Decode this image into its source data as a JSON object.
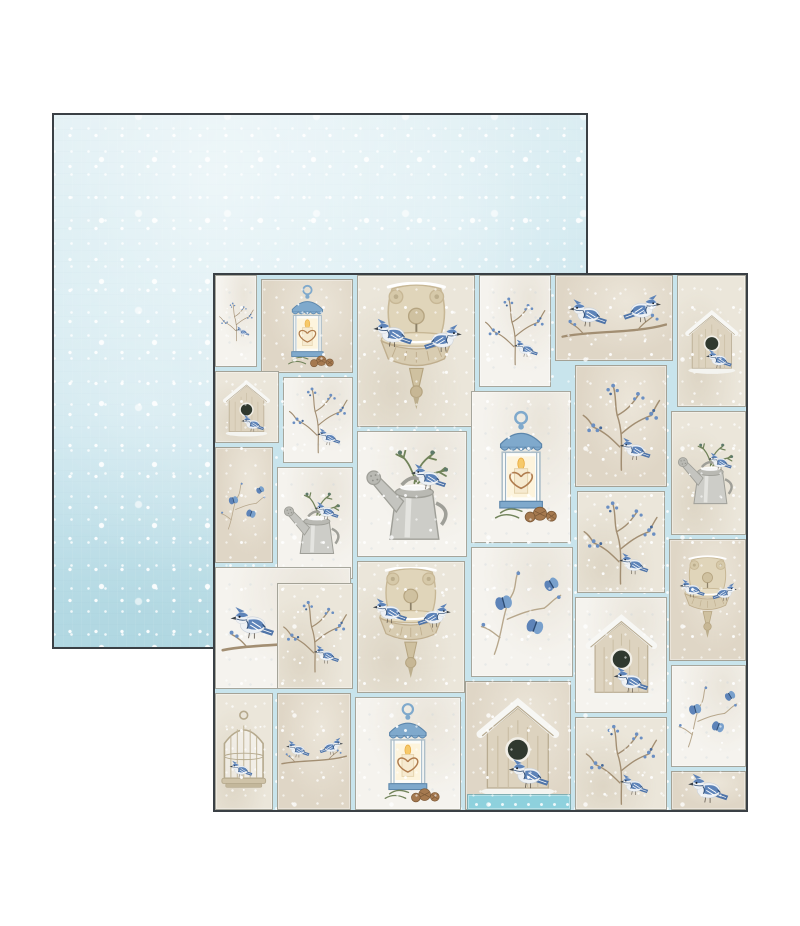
{
  "page": {
    "background": "#ffffff",
    "width": 800,
    "height": 926
  },
  "back_sheet": {
    "label": "snow-texture-paper-side",
    "geometry": {
      "left": 52,
      "top": 113,
      "width": 536,
      "height": 536
    },
    "colors": {
      "base_top": "#dcedf2",
      "base_mid": "#bedfe9",
      "base_deep": "#a9d2dd",
      "speckle": "#ffffff",
      "edge": "#3a4045"
    }
  },
  "front_sheet": {
    "label": "winter-birds-collage-paper-side",
    "geometry": {
      "left": 213,
      "top": 273,
      "width": 535,
      "height": 539
    },
    "colors": {
      "base_blue": "#c8e4ec",
      "edge": "#3a4045",
      "card_border": "#94948a",
      "bird_blue": "#5d83b8",
      "bird_blue_light": "#78a0cc",
      "bird_dark": "#2c4a72",
      "tan": "#ddd2b8",
      "tan_dark": "#c3b493",
      "green": "#71835a",
      "pinecone": "#a5794f",
      "lantern_blue": "#7fa9cc",
      "candle": "#f6ead0",
      "branch": "#a28e72",
      "teal_patch": "#8ed1dd",
      "snow": "#ffffff"
    },
    "tones": {
      "white": "#f5f3ee",
      "cream": "#ebe6da",
      "beige": "#dfd6c6",
      "teal": "#8ed1dd"
    },
    "motif_names": [
      "bird-icon",
      "branch-icon",
      "sprig-icon",
      "birdhouse-icon",
      "lantern-icon",
      "fountain-icon",
      "wateringcan-icon",
      "birdcage-icon",
      "birdpair-icon"
    ],
    "cards": [
      {
        "x": 0,
        "y": 0,
        "w": 42,
        "h": 92,
        "tone": "white",
        "motif": "branch"
      },
      {
        "x": 46,
        "y": 4,
        "w": 92,
        "h": 94,
        "tone": "beige",
        "motif": "lantern"
      },
      {
        "x": 142,
        "y": 0,
        "w": 118,
        "h": 152,
        "tone": "cream",
        "motif": "fountain"
      },
      {
        "x": 264,
        "y": 0,
        "w": 72,
        "h": 112,
        "tone": "white",
        "motif": "branch"
      },
      {
        "x": 340,
        "y": 0,
        "w": 118,
        "h": 86,
        "tone": "beige",
        "motif": "birdpair"
      },
      {
        "x": 462,
        "y": 0,
        "w": 69,
        "h": 132,
        "tone": "cream",
        "motif": "birdhouse"
      },
      {
        "x": 0,
        "y": 96,
        "w": 64,
        "h": 72,
        "tone": "cream",
        "motif": "birdhouse"
      },
      {
        "x": 68,
        "y": 102,
        "w": 70,
        "h": 86,
        "tone": "white",
        "motif": "branch"
      },
      {
        "x": 142,
        "y": 156,
        "w": 110,
        "h": 126,
        "tone": "white",
        "motif": "wateringcan"
      },
      {
        "x": 256,
        "y": 116,
        "w": 100,
        "h": 152,
        "tone": "white",
        "motif": "lantern"
      },
      {
        "x": 360,
        "y": 90,
        "w": 92,
        "h": 122,
        "tone": "beige",
        "motif": "branch"
      },
      {
        "x": 456,
        "y": 136,
        "w": 75,
        "h": 124,
        "tone": "cream",
        "motif": "wateringcan"
      },
      {
        "x": 0,
        "y": 172,
        "w": 58,
        "h": 116,
        "tone": "beige",
        "motif": "sprig"
      },
      {
        "x": 62,
        "y": 192,
        "w": 76,
        "h": 112,
        "tone": "white",
        "motif": "wateringcan"
      },
      {
        "x": 142,
        "y": 286,
        "w": 108,
        "h": 132,
        "tone": "cream",
        "motif": "fountain"
      },
      {
        "x": 256,
        "y": 272,
        "w": 102,
        "h": 130,
        "tone": "white",
        "motif": "sprig"
      },
      {
        "x": 362,
        "y": 216,
        "w": 88,
        "h": 102,
        "tone": "cream",
        "motif": "branch"
      },
      {
        "x": 454,
        "y": 264,
        "w": 77,
        "h": 122,
        "tone": "beige",
        "motif": "fountain"
      },
      {
        "x": 0,
        "y": 292,
        "w": 136,
        "h": 122,
        "tone": "white",
        "motif": "birdpair"
      },
      {
        "x": 140,
        "y": 422,
        "w": 106,
        "h": 113,
        "tone": "white",
        "motif": "lantern"
      },
      {
        "x": 250,
        "y": 406,
        "w": 106,
        "h": 129,
        "tone": "beige",
        "motif": "birdhouse"
      },
      {
        "x": 360,
        "y": 322,
        "w": 92,
        "h": 116,
        "tone": "white",
        "motif": "birdhouse"
      },
      {
        "x": 456,
        "y": 390,
        "w": 75,
        "h": 102,
        "tone": "white",
        "motif": "sprig"
      },
      {
        "x": 0,
        "y": 418,
        "w": 58,
        "h": 117,
        "tone": "cream",
        "motif": "birdcage"
      },
      {
        "x": 62,
        "y": 308,
        "w": 76,
        "h": 106,
        "tone": "cream",
        "motif": "branch"
      },
      {
        "x": 62,
        "y": 418,
        "w": 74,
        "h": 117,
        "tone": "beige",
        "motif": "birdpair"
      },
      {
        "x": 360,
        "y": 442,
        "w": 92,
        "h": 93,
        "tone": "cream",
        "motif": "branch"
      },
      {
        "x": 456,
        "y": 496,
        "w": 75,
        "h": 39,
        "tone": "beige",
        "motif": "bird"
      },
      {
        "x": 252,
        "y": 519,
        "w": 104,
        "h": 16,
        "tone": "teal",
        "motif": "none"
      }
    ]
  }
}
